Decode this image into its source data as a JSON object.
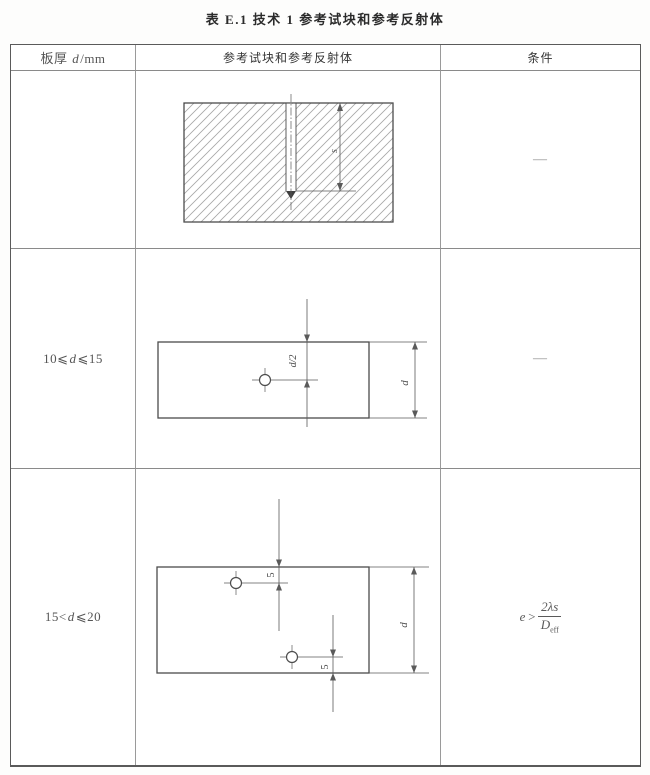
{
  "title": "表 E.1  技术 1 参考试块和参考反射体",
  "table": {
    "header": {
      "thickness": {
        "pre": "板厚 ",
        "var": "d",
        "post": "/mm"
      },
      "reference": "参考试块和参考反射体",
      "condition": "条件"
    },
    "rows": [
      {
        "thickness": {
          "pre": "",
          "var": "",
          "post": ""
        },
        "condition": "—"
      },
      {
        "thickness": {
          "pre": "10⩽",
          "var": "d",
          "post": "⩽15"
        },
        "condition": "—"
      },
      {
        "thickness": {
          "pre": "15<",
          "var": "d",
          "post": "⩽20"
        }
      }
    ]
  },
  "drawings": {
    "block": {
      "depth_label": "s"
    },
    "plate1": {
      "offset_label": "d/2",
      "thickness_label": "d"
    },
    "plate2": {
      "top_offset_label": "5",
      "bottom_offset_label": "5",
      "thickness_label": "d"
    }
  },
  "formula": {
    "lhs": "e",
    "relation": ">",
    "numerator": "2λs",
    "den_base": "D",
    "den_sub": "eff"
  },
  "colors": {
    "line": "#555555",
    "hatch": "#a6a6a6",
    "border_outer": "#5a5a5a",
    "border_inner": "#8a8a8a"
  }
}
